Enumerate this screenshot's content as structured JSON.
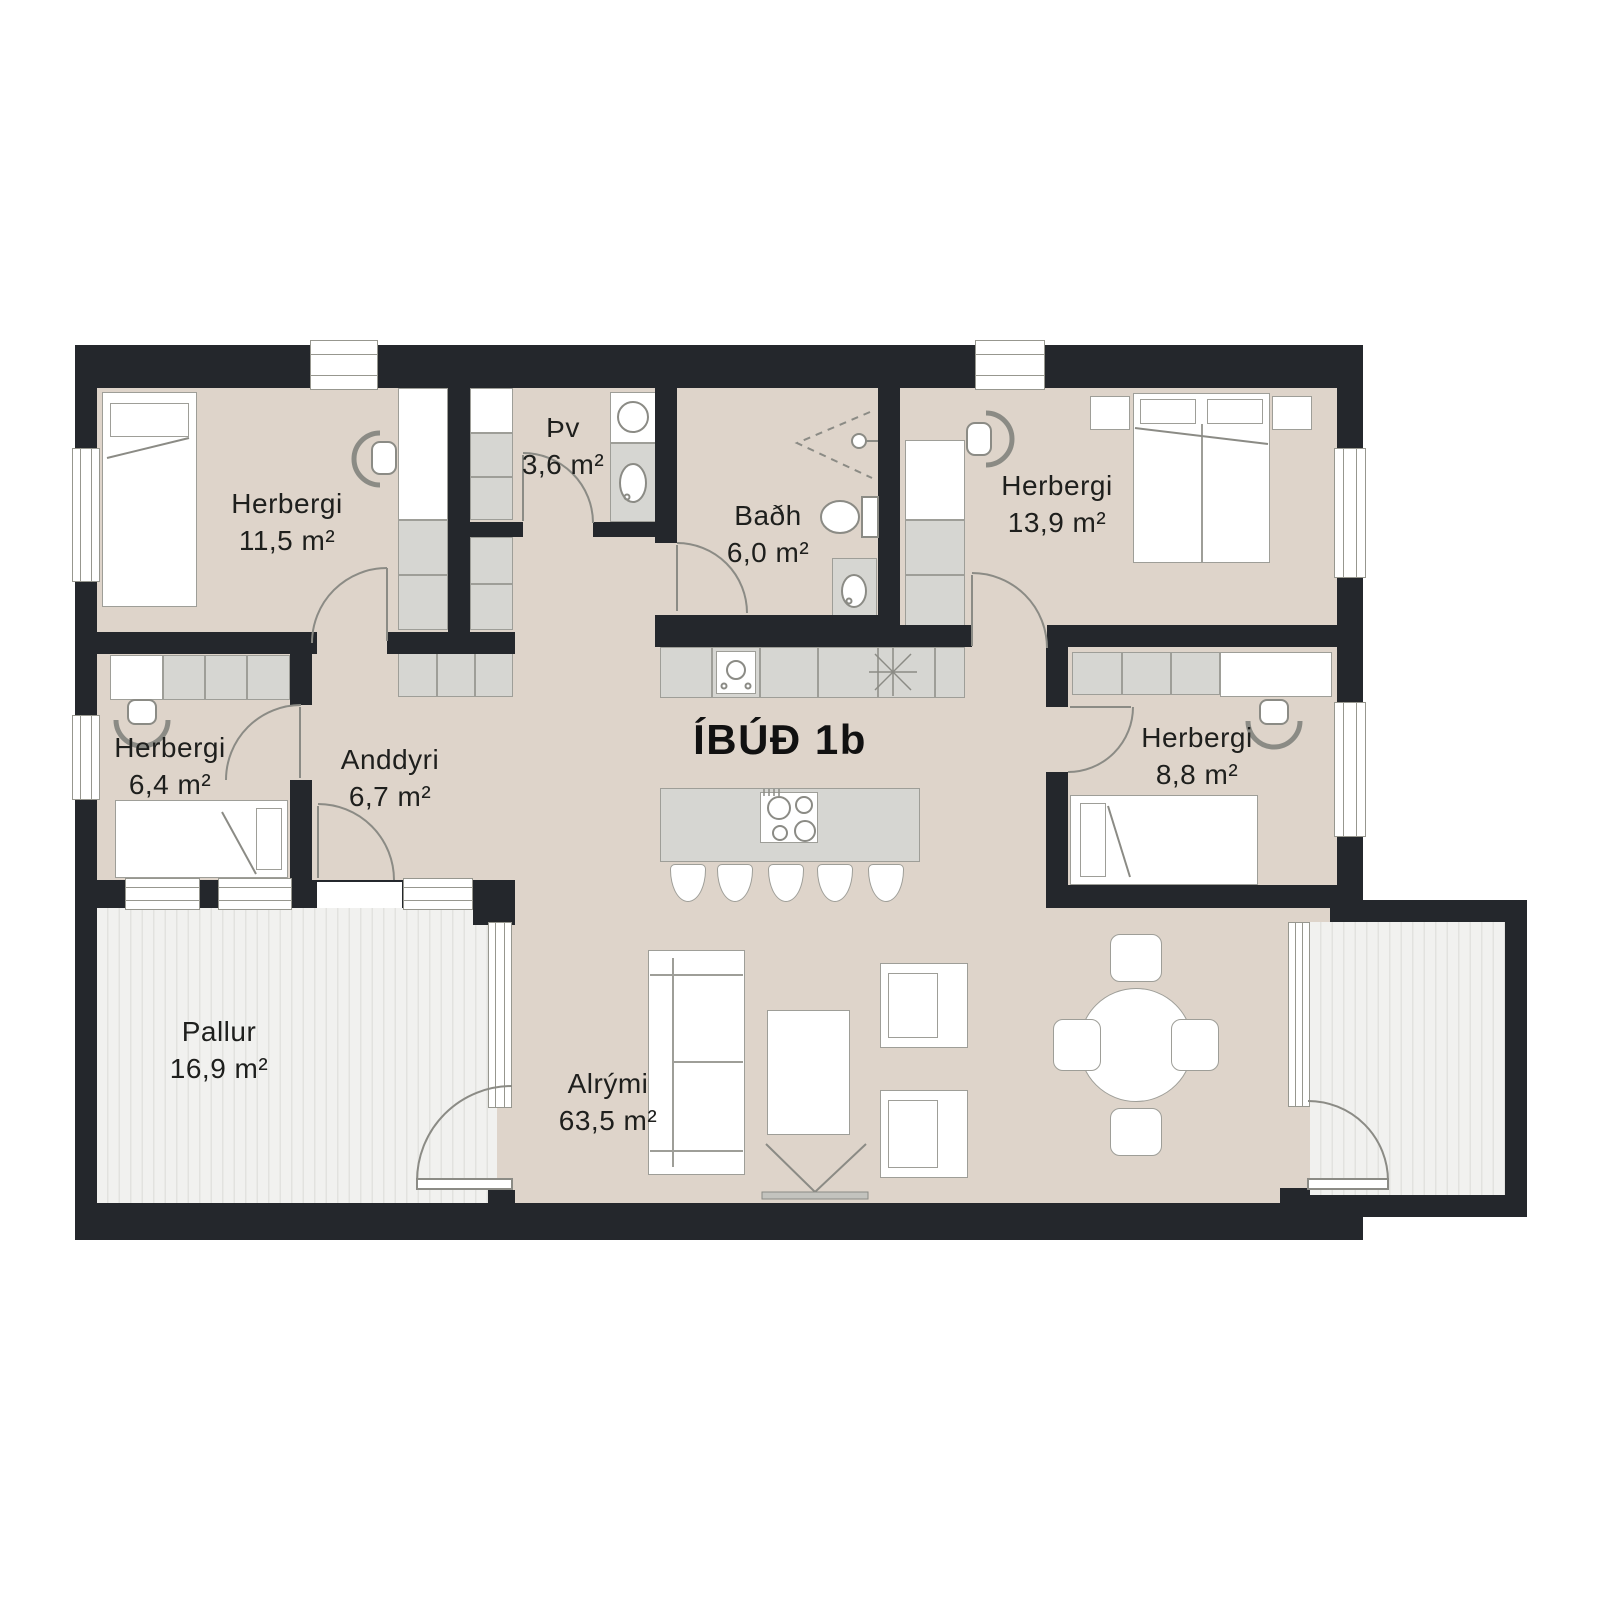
{
  "title": "ÍBÚÐ 1b",
  "rooms": [
    {
      "name": "Herbergi",
      "area": "11,5 m²"
    },
    {
      "name": "Þv",
      "area": "3,6 m²"
    },
    {
      "name": "Baðh",
      "area": "6,0 m²"
    },
    {
      "name": "Herbergi",
      "area": "13,9 m²"
    },
    {
      "name": "Herbergi",
      "area": "6,4 m²"
    },
    {
      "name": "Anddyri",
      "area": "6,7 m²"
    },
    {
      "name": "Herbergi",
      "area": "8,8 m²"
    },
    {
      "name": "Alrými",
      "area": "63,5 m²"
    },
    {
      "name": "Pallur",
      "area": "16,9 m²"
    }
  ],
  "colors": {
    "wall": "#24272c",
    "floor": "#ded4ca",
    "cabinet": "#d6d6d2",
    "deck": "#f1f1ef",
    "line": "#8b8b85",
    "text": "#1e1f1d"
  }
}
